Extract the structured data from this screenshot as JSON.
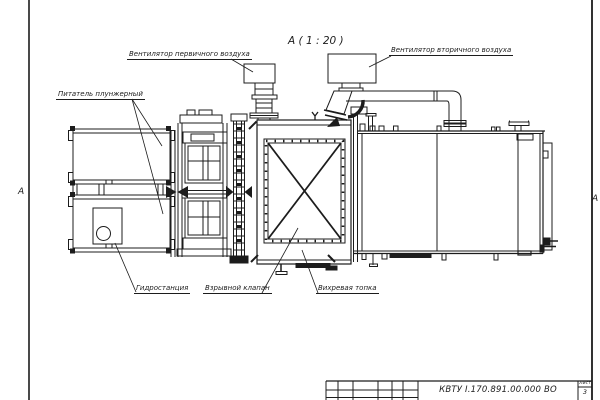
{
  "drawing": {
    "view_title": "А ( 1 : 20 )",
    "section_marker_left": "А",
    "section_marker_right": "А",
    "labels": {
      "primary_fan": "Вентилятор первичного воздуха",
      "secondary_fan": "Вентилятор вторичного воздуха",
      "feeder": "Питатель плунжерный",
      "hydraulic_station": "Гидростанция",
      "explosion_valve": "Взрывной клапан",
      "vortex_furnace": "Вихревая топка"
    },
    "title_block": {
      "document_number": "КВТУ I.170.891.00.000 ВО",
      "sheet_label": "Лист",
      "sheet_number": "3"
    },
    "colors": {
      "line": "#1c1c1c",
      "paper": "#ffffff"
    }
  }
}
